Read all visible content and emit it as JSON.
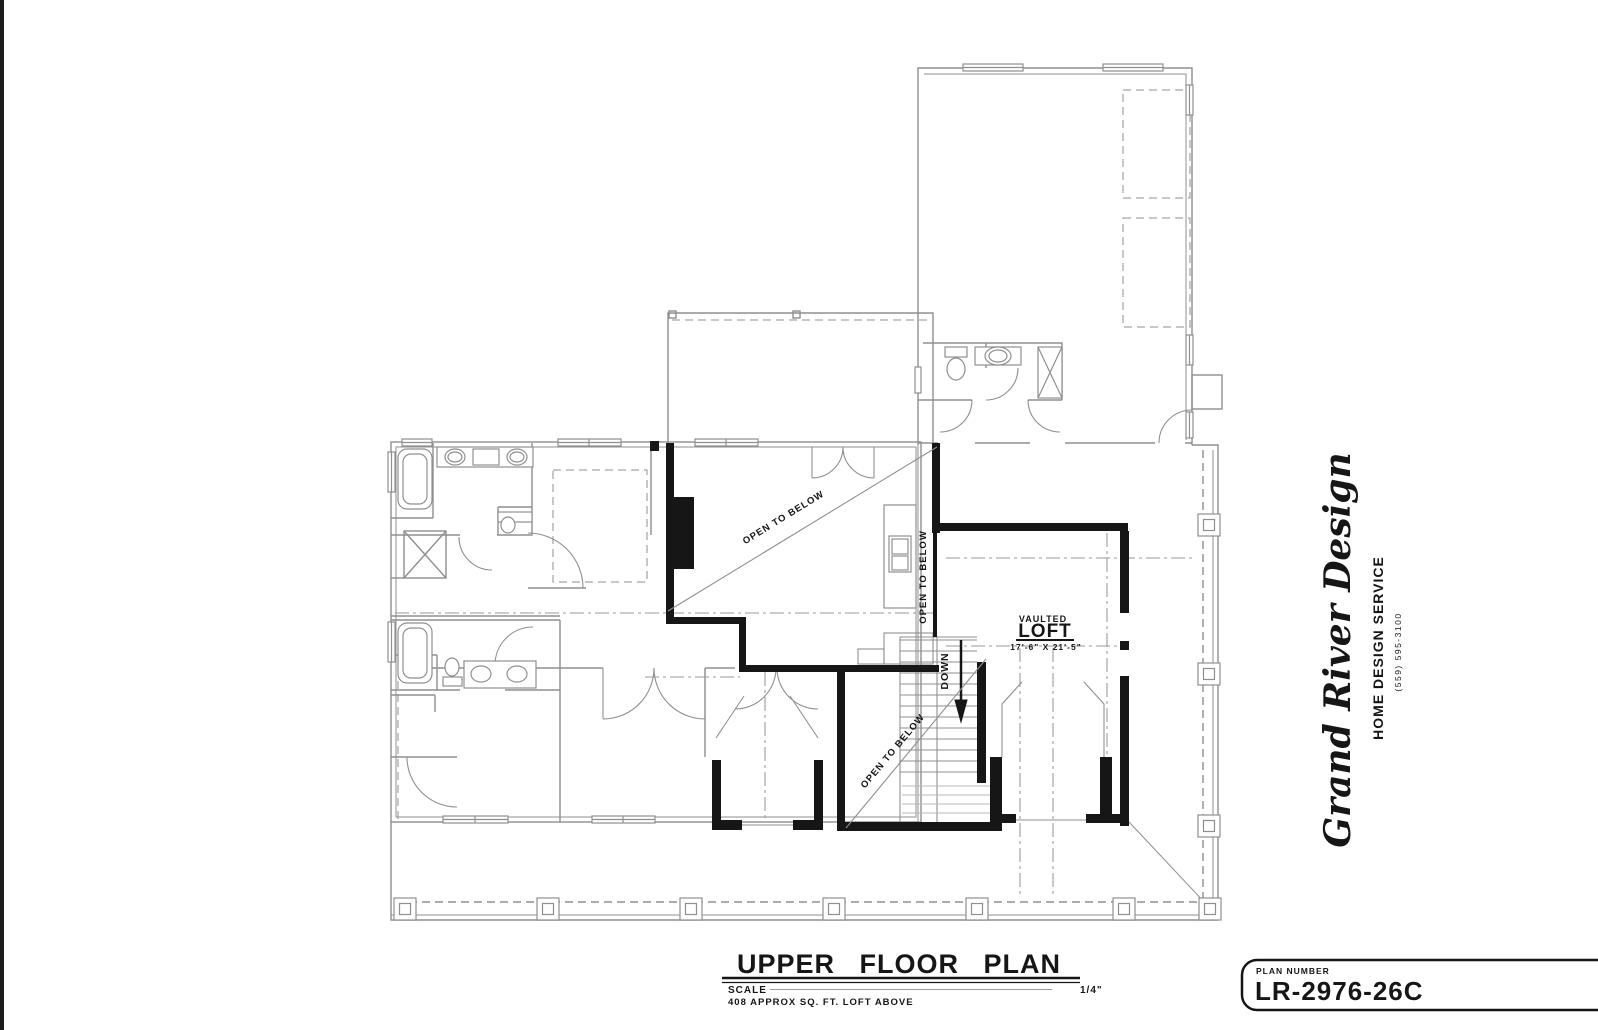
{
  "page": {
    "background": "#ffffff",
    "scan_edge_color": "#1c1c1c"
  },
  "plan": {
    "labels": {
      "vaulted": "VAULTED",
      "loft": "LOFT",
      "loft_dimensions": "17'-6\" X 21'-5\"",
      "open_to_below": "OPEN TO BELOW",
      "down": "DOWN"
    },
    "colors": {
      "underlay_gray": "#8f8f8f",
      "wall_black": "#161616",
      "tread_light": "#b9b9b9"
    }
  },
  "title_block": {
    "title": "UPPER FLOOR PLAN",
    "scale_label": "SCALE",
    "scale_value": "1/4\"",
    "area_note": "408  APPROX SQ. FT. LOFT ABOVE"
  },
  "plan_number_box": {
    "label": "PLAN NUMBER",
    "number": "LR-2976-26C"
  },
  "branding": {
    "company": "Grand River Design",
    "tagline": "HOME DESIGN SERVICE",
    "phone": "(559) 595-3100"
  }
}
